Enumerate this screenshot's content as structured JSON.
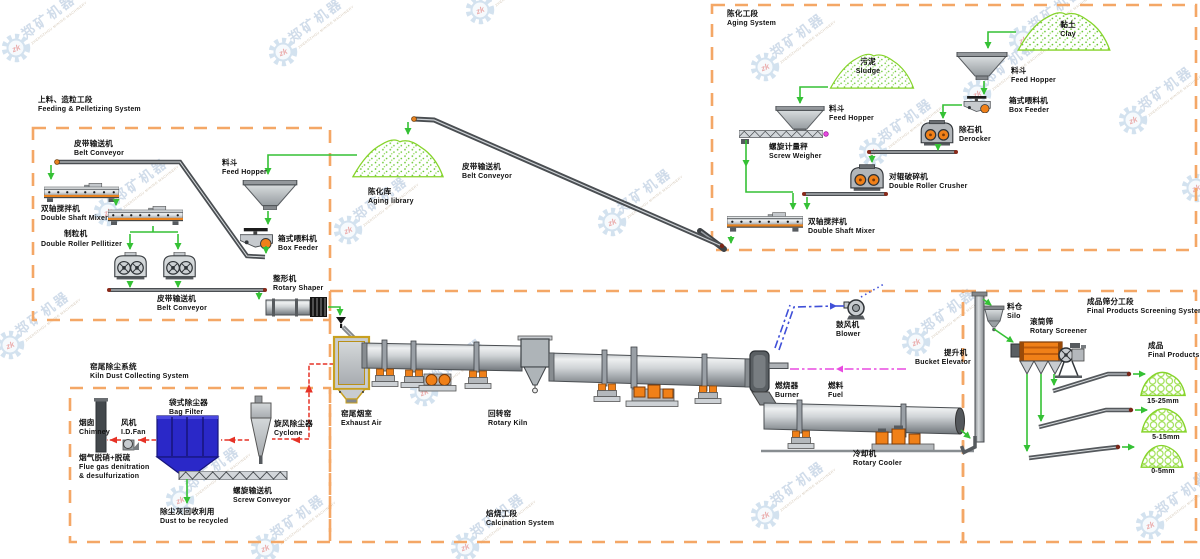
{
  "watermark": {
    "zk": "zk",
    "zh": "郑矿机器",
    "en": "ZHENGZHOU MINING MACHINERY"
  },
  "sections": {
    "feeding": {
      "title_zh": "上料、造粒工段",
      "title_en": "Feeding & Pelletizing System"
    },
    "aging": {
      "title_zh": "陈化工段",
      "title_en": "Aging System"
    },
    "kiln_dust": {
      "title_zh": "窑尾除尘系统",
      "title_en": "Kiln Dust Collecting System"
    },
    "calcination": {
      "title_zh": "焙烧工段",
      "title_en": "Calcination System"
    },
    "screening": {
      "title_zh": "成品筛分工段",
      "title_en": "Final Products Screening System"
    }
  },
  "labels": {
    "belt_conveyor": {
      "zh": "皮带输送机",
      "en": "Belt Conveyor"
    },
    "feed_hopper": {
      "zh": "料斗",
      "en": "Feed Hopper"
    },
    "double_shaft_mixer": {
      "zh": "双轴搅拌机",
      "en": "Double Shaft Mixer"
    },
    "box_feeder": {
      "zh": "箱式喂料机",
      "en": "Box Feeder"
    },
    "pellitizer": {
      "zh": "制粒机",
      "en": "Double Roller Pellitizer"
    },
    "rotary_shaper": {
      "zh": "整形机",
      "en": "Rotary Shaper"
    },
    "aging_library": {
      "zh": "陈化库",
      "en": "Aging library"
    },
    "clay": {
      "zh": "黏土",
      "en": "Clay"
    },
    "sludge": {
      "zh": "污泥",
      "en": "Sludge"
    },
    "screw_weigher": {
      "zh": "螺旋计量秤",
      "en": "Screw Weigher"
    },
    "derocker": {
      "zh": "除石机",
      "en": "Derocker"
    },
    "double_roller_crusher": {
      "zh": "对辊破碎机",
      "en": "Double Roller Crusher"
    },
    "chimney": {
      "zh": "烟囱",
      "en": "Chimney"
    },
    "id_fan": {
      "zh": "风机",
      "en": "I.D.Fan"
    },
    "bag_filter": {
      "zh": "袋式除尘器",
      "en": "Bag Filter"
    },
    "cyclone": {
      "zh": "旋风除尘器",
      "en": "Cyclone"
    },
    "flue_gas": {
      "zh": "烟气脱硝+脱硫",
      "en1": "Flue gas denitration",
      "en2": "& desulfurization"
    },
    "screw_conveyor": {
      "zh": "螺旋输送机",
      "en": "Screw Conveyor"
    },
    "dust_recycled": {
      "zh": "除尘灰回收利用",
      "en": "Dust to be recycled"
    },
    "exhaust_air": {
      "zh": "窑尾烟室",
      "en": "Exhaust Air"
    },
    "rotary_kiln": {
      "zh": "回转窑",
      "en": "Rotary Kiln"
    },
    "blower": {
      "zh": "鼓风机",
      "en": "Blower"
    },
    "burner": {
      "zh": "燃烧器",
      "en": "Burner"
    },
    "fuel": {
      "zh": "燃料",
      "en": "Fuel"
    },
    "rotary_cooler": {
      "zh": "冷却机",
      "en": "Rotary Cooler"
    },
    "bucket_elevator": {
      "zh": "提升机",
      "en": "Bucket Elevator"
    },
    "silo": {
      "zh": "料仓",
      "en": "Silo"
    },
    "rotary_screener": {
      "zh": "滚筒筛",
      "en": "Rotary Screener"
    },
    "final_products": {
      "zh": "成品",
      "en": "Final Products"
    },
    "sizes": {
      "s1": "15-25mm",
      "s2": "5-15mm",
      "s3": "0-5mm"
    }
  },
  "colors": {
    "boundary_orange": "#f4a766",
    "flow_green": "#35c135",
    "flow_red": "#e63226",
    "flow_blue": "#4050d8",
    "flow_magenta": "#e84ae0",
    "equipment_orange": "#f08018",
    "bag_filter_blue": "#2a28c8",
    "pile_green": "#86d42a"
  }
}
